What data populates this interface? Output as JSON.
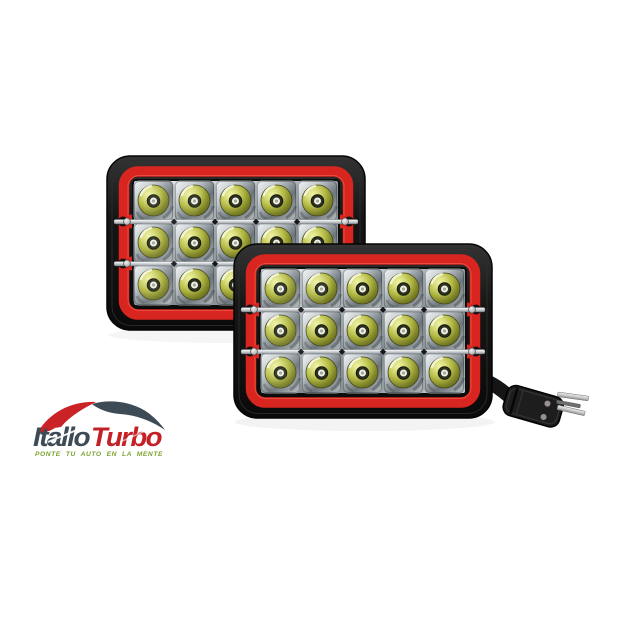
{
  "page": {
    "background_color": "#ffffff"
  },
  "brand": {
    "name": "ItalloTurbo",
    "part1": "Itallo",
    "part2": "Turbo",
    "tagline": "PONTE TU AUTO EN LA MENTE",
    "colors": {
      "wordmark_dark": "#3c4b55",
      "wordmark_red": "#c42127",
      "tagline_green": "#7aa32e"
    }
  },
  "product": {
    "lamp_count": 2,
    "led_rows": 3,
    "led_columns": 5,
    "leds_per_lamp": 15,
    "colors": {
      "housing_black": "#141414",
      "bezel_red": "#d8251f",
      "lens_yellow_green": "#b3b944",
      "reflector_chrome": "#c2c9cd",
      "connector_black": "#1d1d1d",
      "prong_silver": "#d9d9d9"
    }
  }
}
